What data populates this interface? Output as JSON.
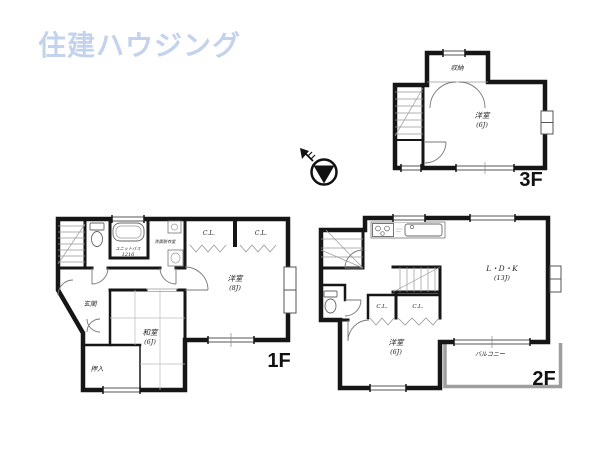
{
  "brand": {
    "logo": "住建ハウジング",
    "logo_color": "#c3d3ee"
  },
  "colors": {
    "wall": "#161616",
    "fixture": "#777777",
    "balcony_wall": "#9e9e9e"
  },
  "floor1": {
    "label": "1F",
    "room_yoshitsu": "洋室",
    "room_yoshitsu_size": "(8J)",
    "room_washitsu": "和室",
    "room_washitsu_size": "(6J)",
    "genkan": "玄関",
    "oshiire": "押入",
    "cl_left": "C.L.",
    "cl_right": "C.L.",
    "unit_bath_line1": "ユニットバス",
    "unit_bath_line2": "1216",
    "senmen": "洗面脱衣室"
  },
  "floor2": {
    "label": "2F",
    "ldk": "L・D・K",
    "ldk_size": "(13J)",
    "room_yoshitsu": "洋室",
    "room_yoshitsu_size": "(6J)",
    "cl_left": "C.L.",
    "cl_right": "C.L.",
    "balcony": "バルコニー"
  },
  "floor3": {
    "label": "3F",
    "room_yoshitsu": "洋室",
    "room_yoshitsu_size": "(6J)",
    "shunou": "収納"
  }
}
